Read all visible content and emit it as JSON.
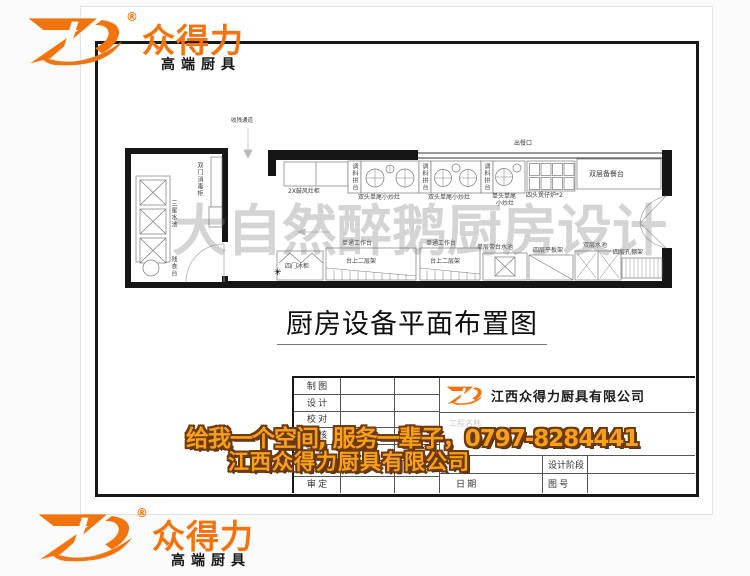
{
  "logo": {
    "mark": "ZD-swoosh-mark",
    "reg": "®",
    "brand": "众得力",
    "tagline": "高端厨具"
  },
  "watermark": "大自然醉鹅厨房设计",
  "drawing_title": "厨房设备平面布置图",
  "plan": {
    "passage": "收残通道",
    "serving": "出餐口",
    "sterilizer": "双门消毒柜",
    "sink3": "三星水池",
    "waste_table": "残食台",
    "blower_cabinet": "2X鼓风灶柜",
    "spice_stands": [
      "调料拼台",
      "调料拼台",
      "调料拼台"
    ],
    "double_wok": [
      "双头单尾小炒灶",
      "双头单尾小炒灶"
    ],
    "single_wok_line1": "单头单尾",
    "single_wok_line2": "小炒灶",
    "pot_stove": "四头煲仔炉*2",
    "prep_counter": "双层备餐台",
    "freezer": "四门冰柜",
    "star": "✳",
    "work_tables": [
      "单通工作台",
      "单通工作台"
    ],
    "table_shelves": [
      "台上二层架",
      "台上二层架"
    ],
    "counter_sink": "单层带台水池",
    "flat_shelf": "四层平板架",
    "double_sink": "双层水池",
    "perf_shelf": "四层孔棚架"
  },
  "title_block": {
    "rows": [
      "制 图",
      "设 计",
      "校 对",
      "审 核",
      "审 批",
      "工程负责人",
      "审 定"
    ],
    "company": "江西众得力厨具有限公司",
    "project_label": "工程名称",
    "stage_label": "设计阶段",
    "date_label": "日 期",
    "number_label": "图 号"
  },
  "ad": {
    "line1": "给我一个空间, 服务一辈子，0797-8284441",
    "line2": "江西众得力厨具有限公司"
  },
  "colors": {
    "brand_orange": "#f2740e",
    "ad_fill_orange": "#f9a01b",
    "ad_outline_brown": "#6d3a10"
  }
}
